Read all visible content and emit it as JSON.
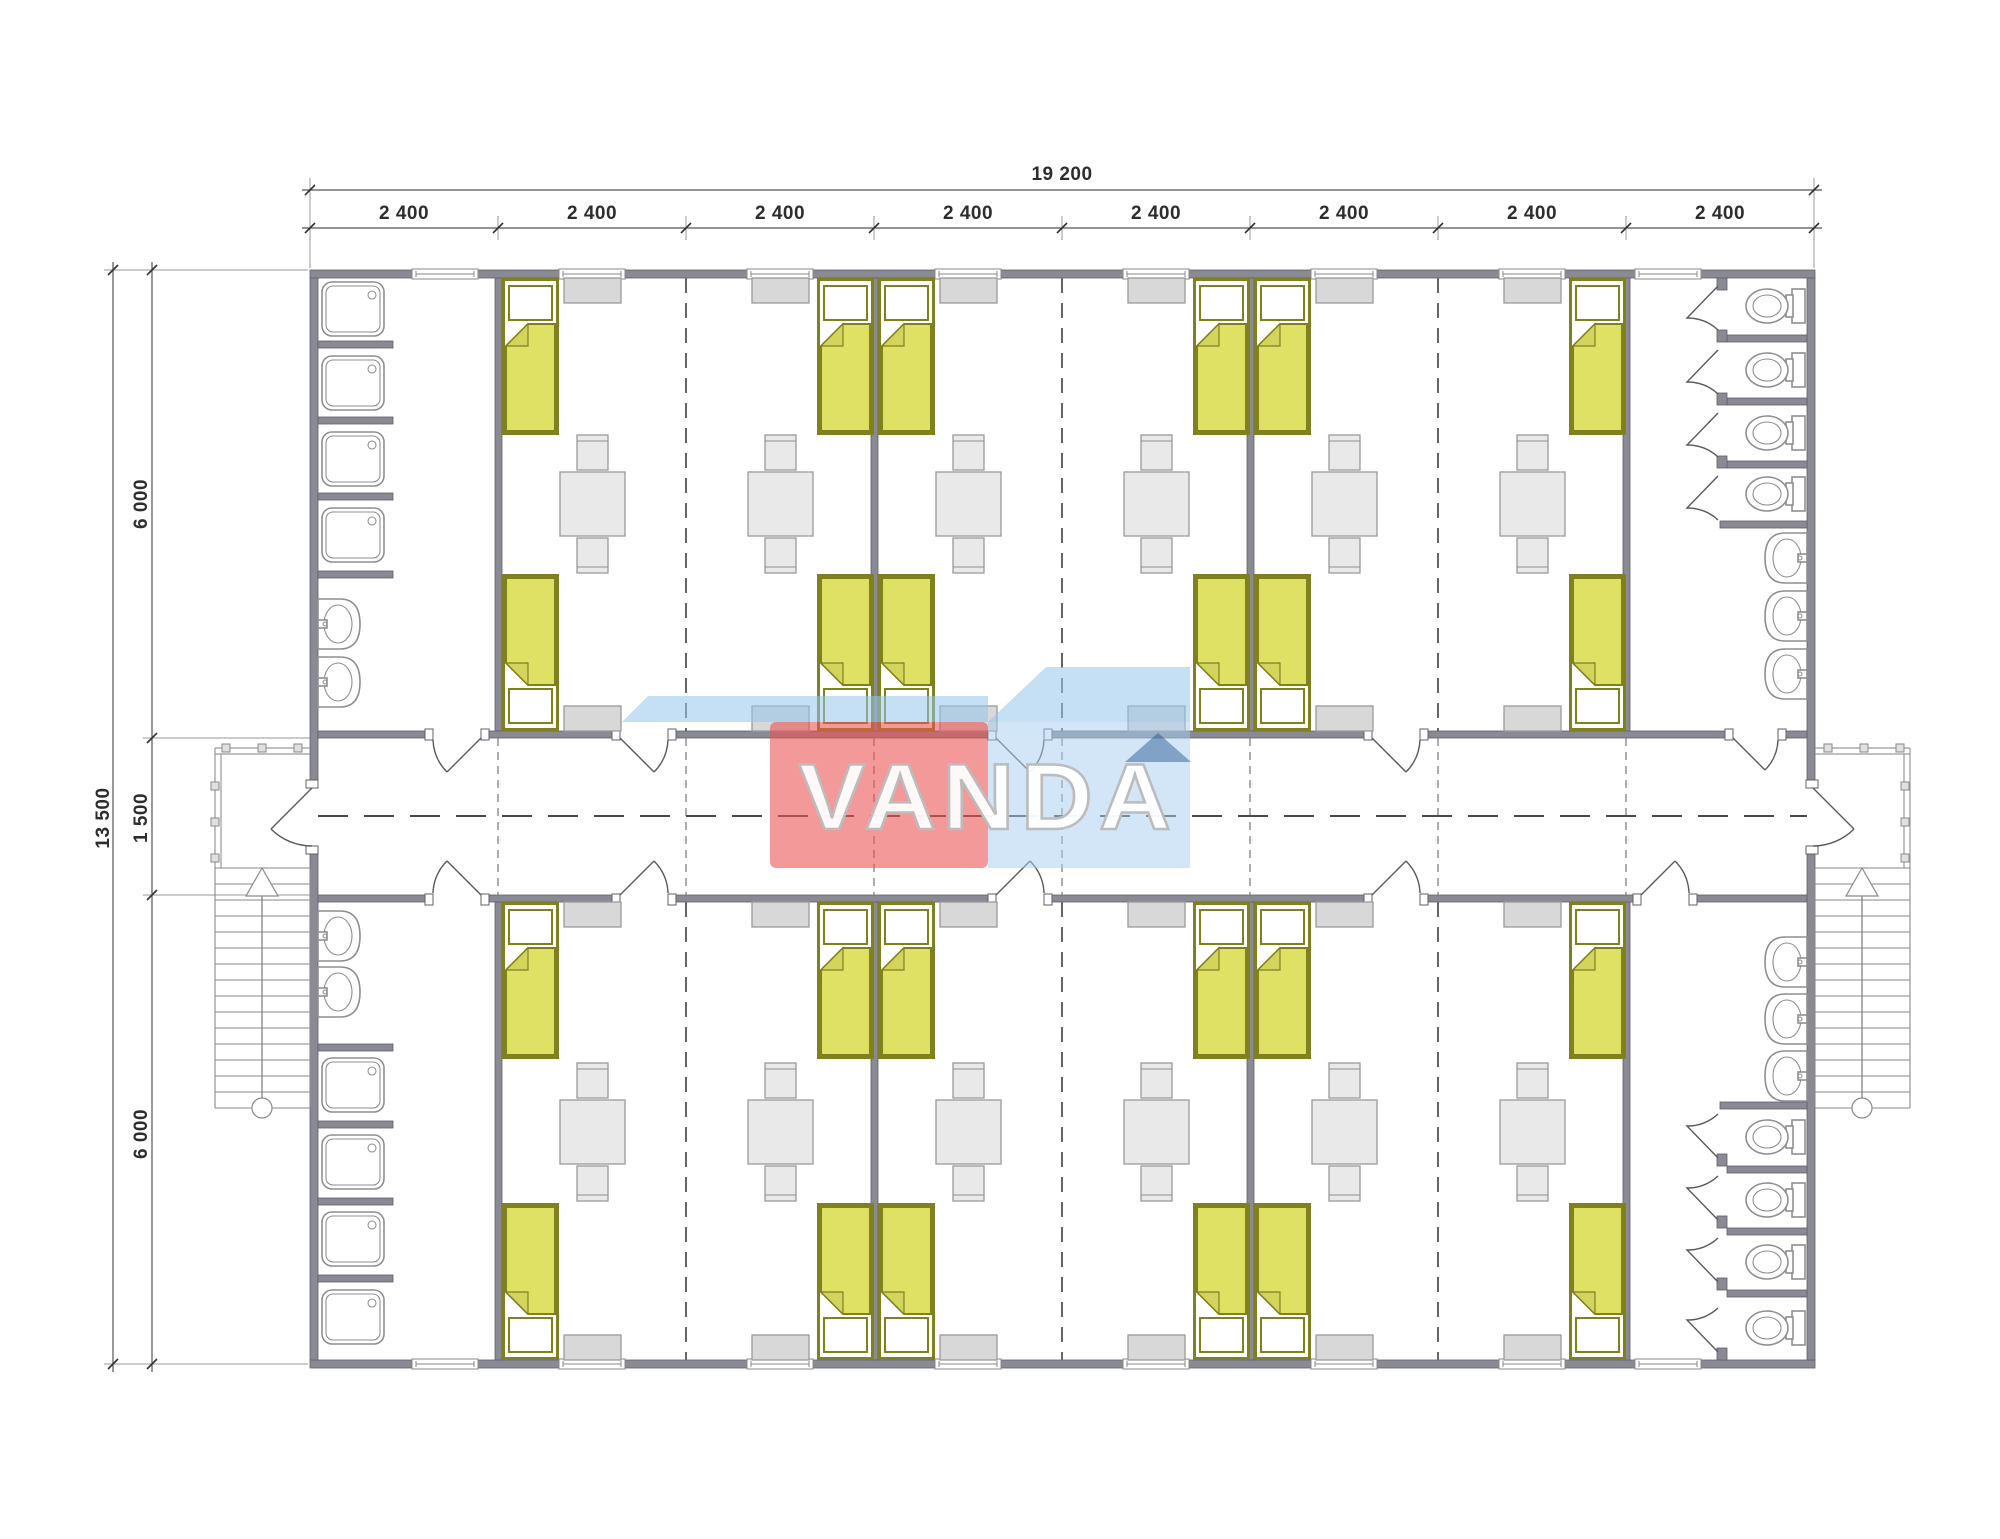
{
  "title": "modular dormitory floor plan",
  "watermark": {
    "text": "VANDA"
  },
  "dims": {
    "top": {
      "total": "19 200",
      "segments": [
        "2 400",
        "2 400",
        "2 400",
        "2 400",
        "2 400",
        "2 400",
        "2 400",
        "2 400"
      ]
    },
    "left": {
      "total": "13 500",
      "segments": [
        "6 000",
        "1 500",
        "6 000"
      ]
    }
  },
  "colors": {
    "wall": "#8a8a94",
    "wallEdge": "#60606a",
    "bedFill": "#dfe165",
    "bedEdge": "#7f811f",
    "bedFlap": "#d2d45c",
    "furn": "#e9e9e9",
    "furnEdge": "#9a9a9a",
    "cab": "#d8d8d8",
    "fix": "#8f8f8f",
    "dash": "#666666",
    "wmRed": "rgba(235,85,85,0.6)",
    "wmBlue": "rgba(165,205,240,0.5)",
    "wmRoof": "rgba(150,198,235,0.55)",
    "wmNavy": "rgba(30,80,140,0.45)",
    "wmText": "rgba(255,255,255,0.93)"
  }
}
